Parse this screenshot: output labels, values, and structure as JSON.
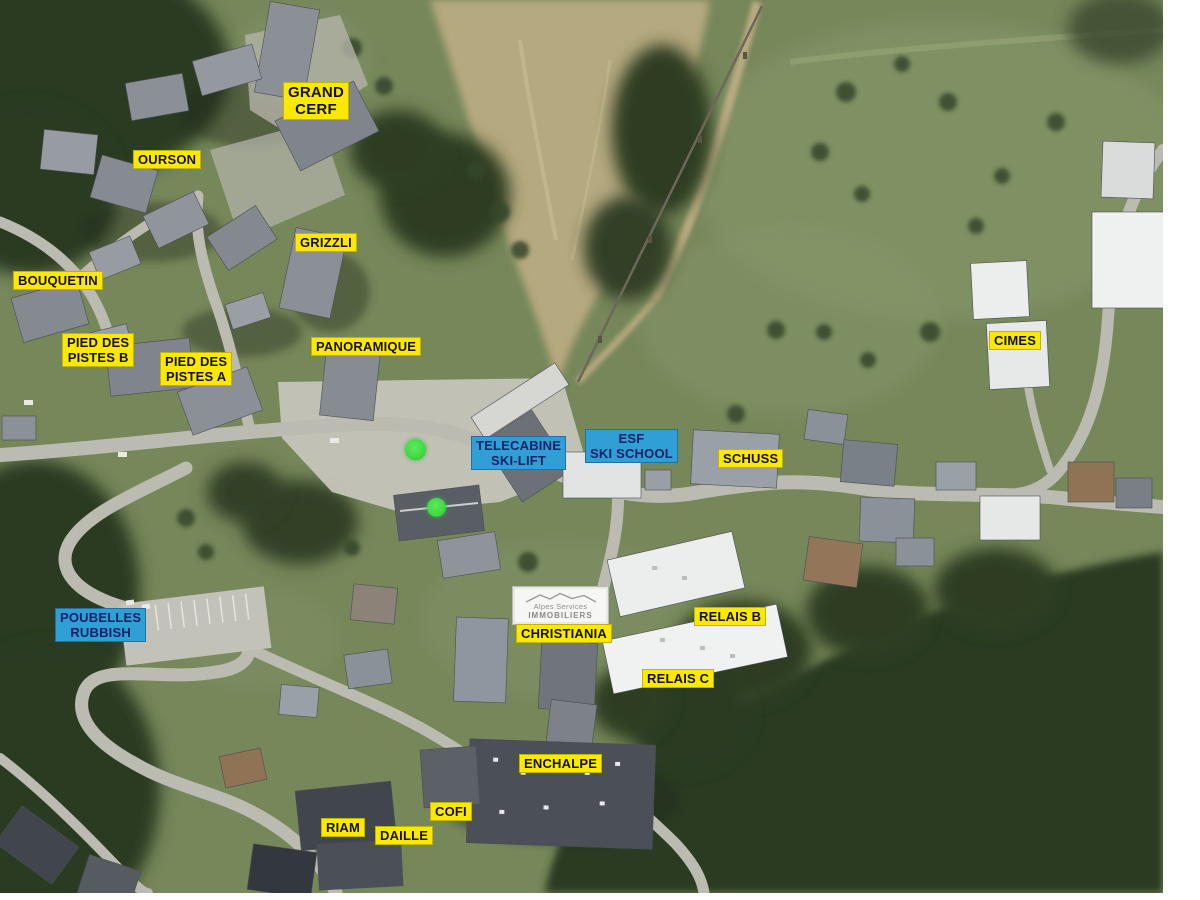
{
  "map": {
    "description": "Aerial satellite view of a ski resort village with labelled buildings",
    "colors": {
      "label_yellow_bg": "#fce903",
      "label_yellow_text": "#121212",
      "label_blue_bg": "#2f9fd6",
      "label_blue_text": "#0d2366",
      "marker_green": "#3fd943"
    }
  },
  "labels": [
    {
      "id": "grand-cerf",
      "text": "GRAND\nCERF",
      "style": "yellow"
    },
    {
      "id": "ourson",
      "text": "OURSON",
      "style": "yellow"
    },
    {
      "id": "grizzli",
      "text": "GRIZZLI",
      "style": "yellow"
    },
    {
      "id": "bouquetin",
      "text": "BOUQUETIN",
      "style": "yellow"
    },
    {
      "id": "pied-des-pistes-b",
      "text": "PIED DES\nPISTES B",
      "style": "yellow"
    },
    {
      "id": "pied-des-pistes-a",
      "text": "PIED DES\nPISTES A",
      "style": "yellow"
    },
    {
      "id": "panoramique",
      "text": "PANORAMIQUE",
      "style": "yellow"
    },
    {
      "id": "telecabine-ski-lift",
      "text": "TELECABINE\nSKI-LIFT",
      "style": "blue"
    },
    {
      "id": "esf-ski-school",
      "text": "ESF\nSKI SCHOOL",
      "style": "blue"
    },
    {
      "id": "schuss",
      "text": "SCHUSS",
      "style": "yellow"
    },
    {
      "id": "cimes",
      "text": "CIMES",
      "style": "yellow"
    },
    {
      "id": "poubelles-rubbish",
      "text": "POUBELLES\nRUBBISH",
      "style": "blue"
    },
    {
      "id": "christiania",
      "text": "CHRISTIANIA",
      "style": "yellow"
    },
    {
      "id": "relais-b",
      "text": "RELAIS B",
      "style": "yellow"
    },
    {
      "id": "relais-c",
      "text": "RELAIS C",
      "style": "yellow"
    },
    {
      "id": "enchalpe",
      "text": "ENCHALPE",
      "style": "yellow"
    },
    {
      "id": "cofi",
      "text": "COFI",
      "style": "yellow"
    },
    {
      "id": "riam",
      "text": "RIAM",
      "style": "yellow"
    },
    {
      "id": "daille",
      "text": "DAILLE",
      "style": "yellow"
    }
  ],
  "logo": {
    "line1": "Alpes Services",
    "line2": "IMMOBILIERS"
  },
  "markers": [
    {
      "id": "green-dot-upper",
      "color": "#3fd943"
    },
    {
      "id": "green-dot-lower",
      "color": "#3fd943"
    }
  ]
}
